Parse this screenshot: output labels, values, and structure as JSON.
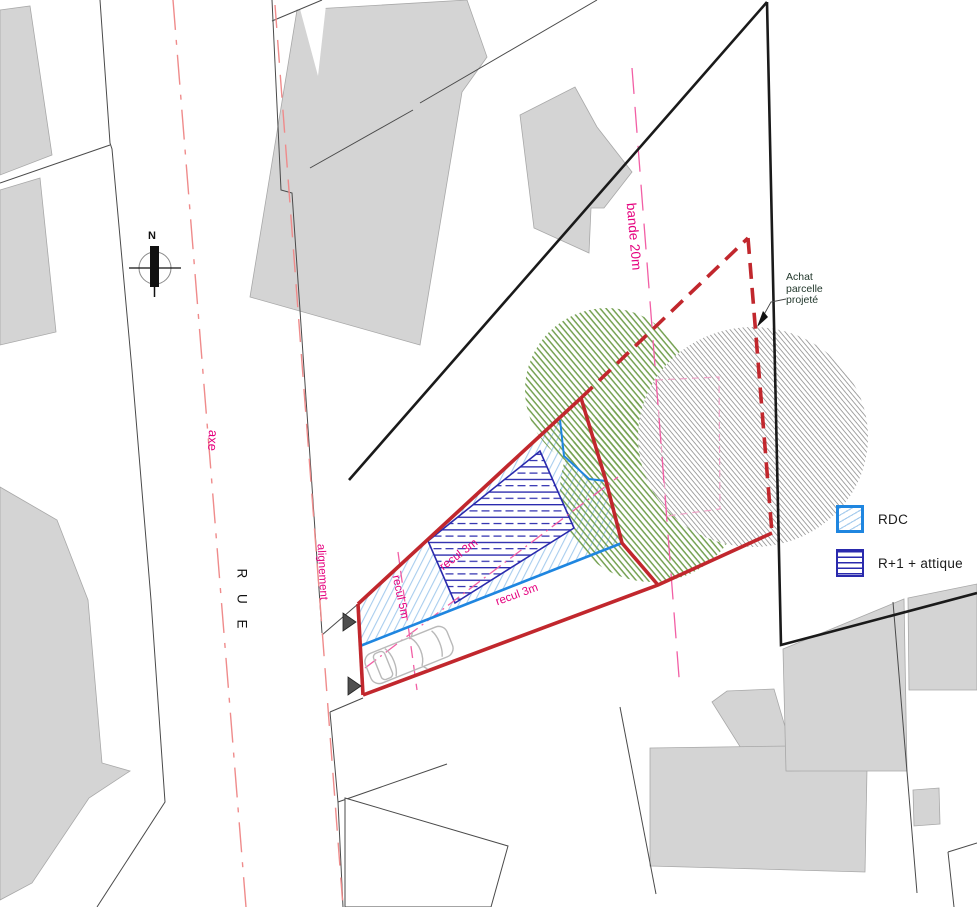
{
  "labels": {
    "north": "N",
    "rue": "R U E",
    "axe": "axe",
    "alignement": "alignement",
    "bande": "bande 20m",
    "recul_5m": "recul 5m",
    "recul_3m_diagonal": "recul 3m",
    "recul_3m_street": "recul 3m"
  },
  "annotation": {
    "line1": "Achat",
    "line2": "parcelle",
    "line3": "projeté"
  },
  "legend": {
    "items": [
      {
        "id": "rdc",
        "label": "RDC"
      },
      {
        "id": "r1_attique",
        "label": "R+1 + attique"
      }
    ]
  },
  "colors": {
    "red": "#c1272d",
    "black_line": "#1a1a1a",
    "thin_line": "#4a4a4a",
    "gray_fill": "#d4d4d4",
    "gray_edge": "#a8a8a8",
    "salmon": "#ef8b8b",
    "magenta": "#e5007e",
    "pink_line": "#f25fa5",
    "pink_light": "#efa3c8",
    "blue": "#1f86e0",
    "blue_hatch": "#a8cdee",
    "navy": "#2a2aad",
    "green": "#75a152",
    "gray_hatch": "#8f8f8f",
    "car_line": "#b9b9b9",
    "marker": "#4f4f4f"
  }
}
